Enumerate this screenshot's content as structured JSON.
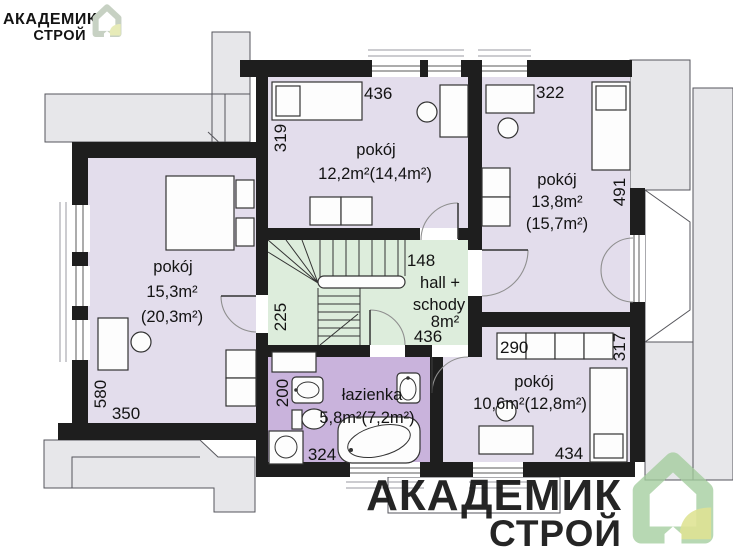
{
  "branding": {
    "top_left": {
      "name": "АКАДЕМИК",
      "sub": "СТРОЙ"
    },
    "bottom_right": {
      "name": "АКАДЕМИК",
      "sub": "СТРОЙ"
    }
  },
  "colors": {
    "wall": "#1e1e1e",
    "room_fill": "#e3ddec",
    "bathroom_fill": "#c9b3dc",
    "hall_fill": "#ddeddc",
    "roof_fill": "#e7e7ea",
    "logo_green": "#a3cc9e",
    "logo_green_light": "#c7d1c3",
    "logo_yellow": "#dbe18c",
    "logo_yellow_light": "#e7ebb8"
  },
  "rooms": {
    "left": {
      "label": "pokój",
      "area": "15,3m²",
      "area_gross": "(20,3m²)"
    },
    "top_middle": {
      "label": "pokój",
      "area": "12,2m²(14,4m²)"
    },
    "top_right": {
      "label": "pokój",
      "area": "13,8m²",
      "area_gross": "(15,7m²)"
    },
    "hall": {
      "label_line1": "hall +",
      "label_line2": "schody",
      "area": "8m²"
    },
    "bathroom": {
      "label": "łazienka",
      "area": "5,8m²(7,2m²)"
    },
    "bottom_right": {
      "label": "pokój",
      "area": "10,6m²(12,8m²)"
    }
  },
  "dimensions_cm": {
    "top_middle_width": "436",
    "top_middle_depth": "319",
    "top_right_width": "322",
    "top_right_depth": "491",
    "hall_width": "148",
    "hall_length": "436",
    "hall_side": "225",
    "left_room_depth": "580",
    "left_room_width": "350",
    "bathroom_side": "200",
    "bathroom_width": "324",
    "wardrobe_width": "290",
    "wardrobe_side": "317",
    "bottom_right_width": "434"
  }
}
